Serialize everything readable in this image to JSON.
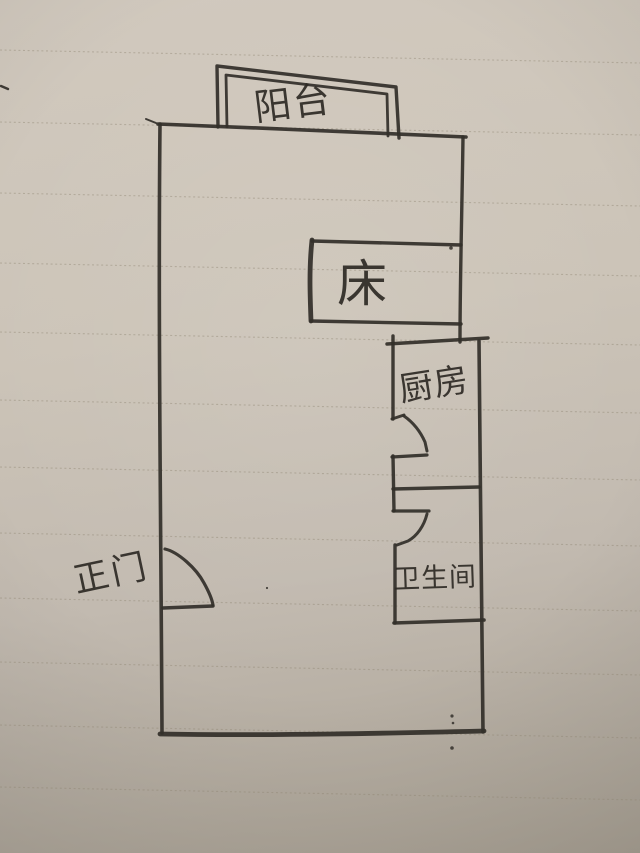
{
  "sketch": {
    "labels": {
      "balcony": "阳台",
      "bed": "床",
      "kitchen": "厨房",
      "bathroom": "卫生间",
      "main_door": "正门"
    },
    "colors": {
      "ink": "#332f2a",
      "paper_light": "#d1c9be",
      "paper_dark": "#aaa295",
      "ruled_line": "#8d8271"
    }
  }
}
